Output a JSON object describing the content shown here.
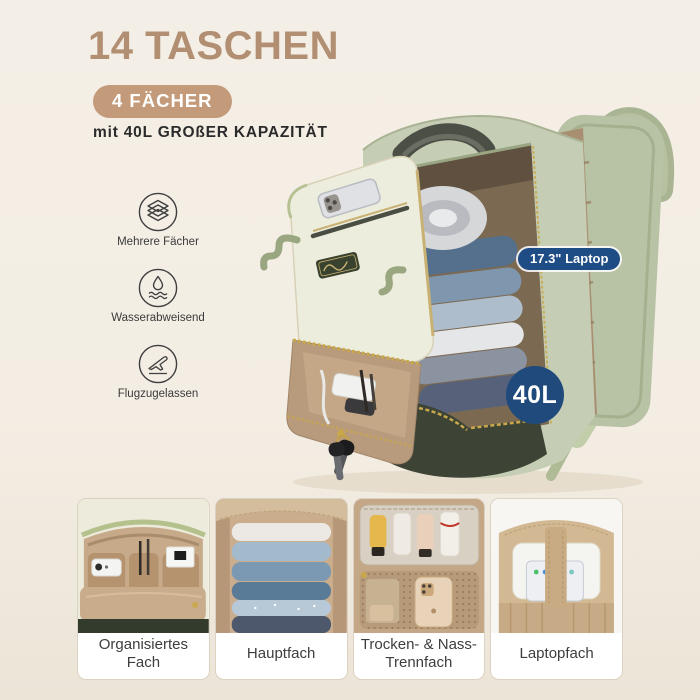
{
  "header": {
    "title": "14 TASCHEN",
    "badge": "4 FÄCHER",
    "subtitle": "mit 40L GROßER KAPAZITÄT"
  },
  "features": {
    "items": [
      {
        "icon": "layers-icon",
        "label": "Mehrere Fächer"
      },
      {
        "icon": "water-drop-icon",
        "label": "Wasserabweisend"
      },
      {
        "icon": "airplane-icon",
        "label": "Flugzugelassen"
      }
    ]
  },
  "callouts": {
    "laptop_badge": "17.3\" Laptop",
    "capacity_badge": "40L"
  },
  "cards": {
    "items": [
      {
        "label": "Organisiertes Fach"
      },
      {
        "label": "Hauptfach"
      },
      {
        "label": "Trocken- & Nass-Trennfach"
      },
      {
        "label": "Laptopfach"
      }
    ]
  },
  "colors": {
    "accent_tan": "#b28f73",
    "pill_tan": "#c39b7b",
    "badge_navy": "#1e4c85",
    "background_cream": "#f3eee5",
    "backpack_sage": "#c5ceb5",
    "backpack_olive": "#3d4435",
    "interior_tan": "#b89b7c"
  }
}
